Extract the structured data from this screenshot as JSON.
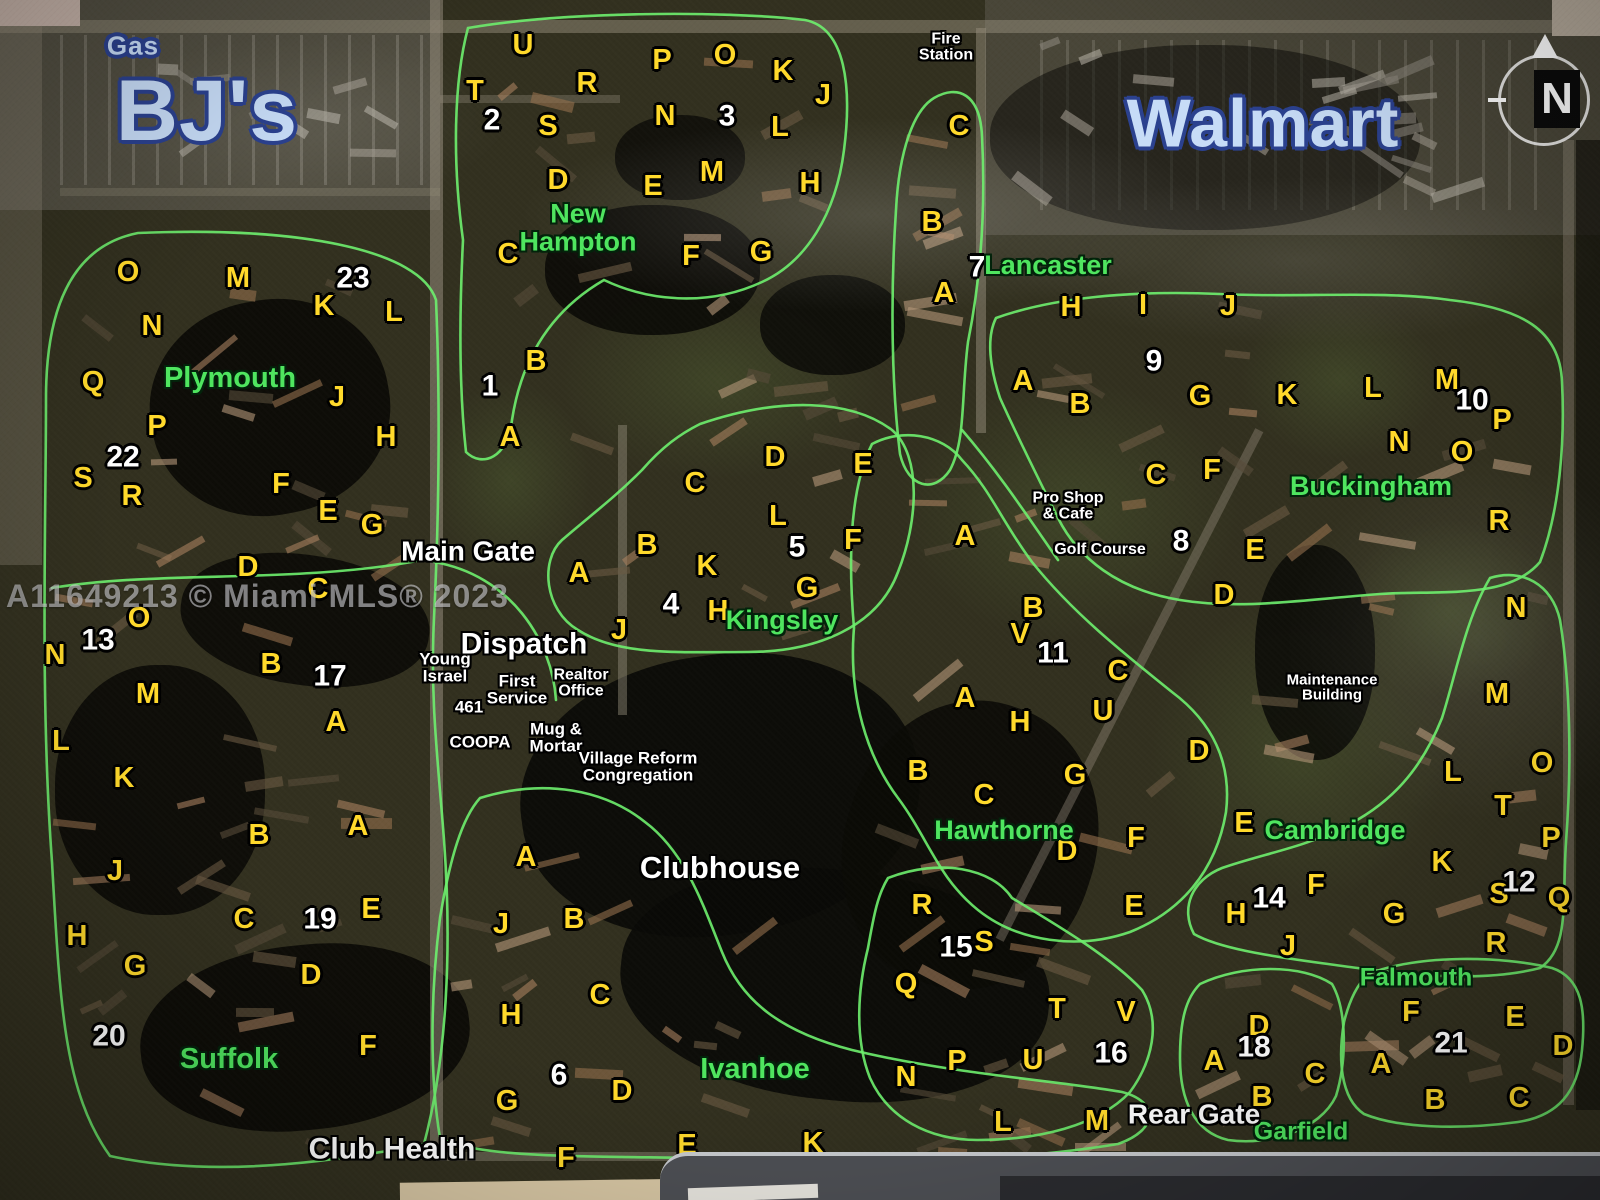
{
  "map": {
    "watermark": {
      "t": "A11649213 © Miami MLS® 2023",
      "x": 168,
      "y": 597
    },
    "compass": {
      "label": "N"
    },
    "colors": {
      "unit_letter": "#ffd92b",
      "block_number": "#ffffff",
      "neighborhood": "#4fe55f",
      "poi": "#ffffff",
      "store_fill": "#c7dcf7",
      "store_outline": "#2b418f",
      "region_outline": "#6ef06e"
    },
    "stores": [
      {
        "t": "Gas",
        "x": 133,
        "y": 46,
        "s": 26
      },
      {
        "t": "BJ's",
        "x": 207,
        "y": 112,
        "s": 86
      },
      {
        "t": "Walmart",
        "x": 1263,
        "y": 124,
        "s": 68
      }
    ],
    "neighborhoods": [
      {
        "t": "New\nHampton",
        "x": 578,
        "y": 228,
        "s": 27
      },
      {
        "t": "Plymouth",
        "x": 230,
        "y": 379,
        "s": 29
      },
      {
        "t": "Lancaster",
        "x": 1048,
        "y": 266,
        "s": 27
      },
      {
        "t": "Buckingham",
        "x": 1371,
        "y": 487,
        "s": 27
      },
      {
        "t": "Kingsley",
        "x": 782,
        "y": 621,
        "s": 27
      },
      {
        "t": "Hawthorne",
        "x": 1004,
        "y": 831,
        "s": 27
      },
      {
        "t": "Cambridge",
        "x": 1335,
        "y": 831,
        "s": 27
      },
      {
        "t": "Suffolk",
        "x": 229,
        "y": 1060,
        "s": 29
      },
      {
        "t": "Ivanhoe",
        "x": 755,
        "y": 1070,
        "s": 29
      },
      {
        "t": "Falmouth",
        "x": 1416,
        "y": 978,
        "s": 25
      },
      {
        "t": "Garfield",
        "x": 1301,
        "y": 1132,
        "s": 25
      }
    ],
    "pois": [
      {
        "t": "Fire\nStation",
        "x": 946,
        "y": 48,
        "s": 16
      },
      {
        "t": "Main Gate",
        "x": 468,
        "y": 552,
        "s": 28
      },
      {
        "t": "Dispatch",
        "x": 524,
        "y": 645,
        "s": 30
      },
      {
        "t": "Young\nIsrael",
        "x": 445,
        "y": 668,
        "s": 17
      },
      {
        "t": "First\nService",
        "x": 517,
        "y": 690,
        "s": 17
      },
      {
        "t": "Realtor\nOffice",
        "x": 581,
        "y": 684,
        "s": 16
      },
      {
        "t": "461",
        "x": 469,
        "y": 707,
        "s": 17
      },
      {
        "t": "COOPA",
        "x": 480,
        "y": 742,
        "s": 17
      },
      {
        "t": "Mug &\nMortar",
        "x": 556,
        "y": 738,
        "s": 17
      },
      {
        "t": "Village Reform\nCongregation",
        "x": 638,
        "y": 767,
        "s": 17
      },
      {
        "t": "Clubhouse",
        "x": 720,
        "y": 868,
        "s": 31
      },
      {
        "t": "Pro Shop\n& Cafe",
        "x": 1068,
        "y": 507,
        "s": 16
      },
      {
        "t": "Golf Course",
        "x": 1100,
        "y": 550,
        "s": 16
      },
      {
        "t": "Maintenance\nBuilding",
        "x": 1332,
        "y": 688,
        "s": 15
      },
      {
        "t": "Club Health",
        "x": 392,
        "y": 1150,
        "s": 30
      },
      {
        "t": "Rear Gate",
        "x": 1194,
        "y": 1115,
        "s": 28
      }
    ],
    "numbers": [
      {
        "t": "1",
        "x": 490,
        "y": 387
      },
      {
        "t": "2",
        "x": 492,
        "y": 121
      },
      {
        "t": "3",
        "x": 727,
        "y": 117
      },
      {
        "t": "4",
        "x": 671,
        "y": 605
      },
      {
        "t": "5",
        "x": 797,
        "y": 548
      },
      {
        "t": "6",
        "x": 559,
        "y": 1076
      },
      {
        "t": "7",
        "x": 977,
        "y": 268
      },
      {
        "t": "8",
        "x": 1181,
        "y": 542
      },
      {
        "t": "9",
        "x": 1154,
        "y": 362
      },
      {
        "t": "10",
        "x": 1472,
        "y": 401
      },
      {
        "t": "11",
        "x": 1053,
        "y": 654
      },
      {
        "t": "12",
        "x": 1519,
        "y": 883
      },
      {
        "t": "13",
        "x": 98,
        "y": 641
      },
      {
        "t": "14",
        "x": 1269,
        "y": 899
      },
      {
        "t": "15",
        "x": 956,
        "y": 948
      },
      {
        "t": "16",
        "x": 1111,
        "y": 1054
      },
      {
        "t": "17",
        "x": 330,
        "y": 677
      },
      {
        "t": "18",
        "x": 1254,
        "y": 1048
      },
      {
        "t": "19",
        "x": 320,
        "y": 920
      },
      {
        "t": "20",
        "x": 109,
        "y": 1037
      },
      {
        "t": "21",
        "x": 1451,
        "y": 1044
      },
      {
        "t": "22",
        "x": 123,
        "y": 458
      },
      {
        "t": "23",
        "x": 353,
        "y": 279
      }
    ],
    "letters": [
      {
        "t": "U",
        "x": 523,
        "y": 46
      },
      {
        "t": "O",
        "x": 725,
        "y": 56
      },
      {
        "t": "P",
        "x": 662,
        "y": 61
      },
      {
        "t": "K",
        "x": 783,
        "y": 72
      },
      {
        "t": "R",
        "x": 587,
        "y": 84
      },
      {
        "t": "T",
        "x": 475,
        "y": 92
      },
      {
        "t": "J",
        "x": 823,
        "y": 96
      },
      {
        "t": "N",
        "x": 665,
        "y": 117
      },
      {
        "t": "S",
        "x": 548,
        "y": 127
      },
      {
        "t": "L",
        "x": 780,
        "y": 128
      },
      {
        "t": "M",
        "x": 712,
        "y": 173
      },
      {
        "t": "D",
        "x": 558,
        "y": 181
      },
      {
        "t": "E",
        "x": 653,
        "y": 187
      },
      {
        "t": "H",
        "x": 810,
        "y": 184
      },
      {
        "t": "C",
        "x": 508,
        "y": 255
      },
      {
        "t": "G",
        "x": 761,
        "y": 253
      },
      {
        "t": "F",
        "x": 691,
        "y": 257
      },
      {
        "t": "B",
        "x": 536,
        "y": 362
      },
      {
        "t": "A",
        "x": 510,
        "y": 438
      },
      {
        "t": "C",
        "x": 959,
        "y": 127
      },
      {
        "t": "B",
        "x": 932,
        "y": 223
      },
      {
        "t": "A",
        "x": 944,
        "y": 294
      },
      {
        "t": "H",
        "x": 1071,
        "y": 308
      },
      {
        "t": "I",
        "x": 1143,
        "y": 306
      },
      {
        "t": "J",
        "x": 1228,
        "y": 307
      },
      {
        "t": "A",
        "x": 1023,
        "y": 382
      },
      {
        "t": "B",
        "x": 1080,
        "y": 405
      },
      {
        "t": "G",
        "x": 1200,
        "y": 397
      },
      {
        "t": "K",
        "x": 1287,
        "y": 396
      },
      {
        "t": "L",
        "x": 1373,
        "y": 389
      },
      {
        "t": "M",
        "x": 1447,
        "y": 381
      },
      {
        "t": "N",
        "x": 1399,
        "y": 443
      },
      {
        "t": "O",
        "x": 1462,
        "y": 453
      },
      {
        "t": "P",
        "x": 1502,
        "y": 421
      },
      {
        "t": "R",
        "x": 1499,
        "y": 522
      },
      {
        "t": "C",
        "x": 1156,
        "y": 476
      },
      {
        "t": "F",
        "x": 1212,
        "y": 471
      },
      {
        "t": "E",
        "x": 1255,
        "y": 551
      },
      {
        "t": "D",
        "x": 1224,
        "y": 596
      },
      {
        "t": "O",
        "x": 128,
        "y": 273
      },
      {
        "t": "M",
        "x": 238,
        "y": 279
      },
      {
        "t": "K",
        "x": 324,
        "y": 307
      },
      {
        "t": "L",
        "x": 394,
        "y": 313
      },
      {
        "t": "N",
        "x": 152,
        "y": 327
      },
      {
        "t": "Q",
        "x": 93,
        "y": 383
      },
      {
        "t": "J",
        "x": 337,
        "y": 398
      },
      {
        "t": "P",
        "x": 157,
        "y": 427
      },
      {
        "t": "H",
        "x": 386,
        "y": 438
      },
      {
        "t": "S",
        "x": 83,
        "y": 479
      },
      {
        "t": "F",
        "x": 281,
        "y": 485
      },
      {
        "t": "R",
        "x": 132,
        "y": 497
      },
      {
        "t": "E",
        "x": 328,
        "y": 512
      },
      {
        "t": "G",
        "x": 372,
        "y": 526
      },
      {
        "t": "D",
        "x": 248,
        "y": 568
      },
      {
        "t": "C",
        "x": 318,
        "y": 590
      },
      {
        "t": "B",
        "x": 271,
        "y": 665
      },
      {
        "t": "A",
        "x": 336,
        "y": 723
      },
      {
        "t": "O",
        "x": 139,
        "y": 619
      },
      {
        "t": "N",
        "x": 55,
        "y": 656
      },
      {
        "t": "M",
        "x": 148,
        "y": 695
      },
      {
        "t": "L",
        "x": 61,
        "y": 742
      },
      {
        "t": "K",
        "x": 124,
        "y": 779
      },
      {
        "t": "J",
        "x": 115,
        "y": 872
      },
      {
        "t": "H",
        "x": 77,
        "y": 937
      },
      {
        "t": "G",
        "x": 135,
        "y": 967
      },
      {
        "t": "D",
        "x": 775,
        "y": 458
      },
      {
        "t": "E",
        "x": 863,
        "y": 465
      },
      {
        "t": "C",
        "x": 695,
        "y": 484
      },
      {
        "t": "L",
        "x": 778,
        "y": 517
      },
      {
        "t": "F",
        "x": 853,
        "y": 541
      },
      {
        "t": "B",
        "x": 647,
        "y": 546
      },
      {
        "t": "K",
        "x": 707,
        "y": 567
      },
      {
        "t": "A",
        "x": 579,
        "y": 574
      },
      {
        "t": "G",
        "x": 807,
        "y": 589
      },
      {
        "t": "H",
        "x": 718,
        "y": 612
      },
      {
        "t": "J",
        "x": 619,
        "y": 631
      },
      {
        "t": "A",
        "x": 965,
        "y": 537
      },
      {
        "t": "B",
        "x": 1033,
        "y": 609
      },
      {
        "t": "V",
        "x": 1020,
        "y": 635
      },
      {
        "t": "C",
        "x": 1118,
        "y": 672
      },
      {
        "t": "A",
        "x": 965,
        "y": 699
      },
      {
        "t": "U",
        "x": 1103,
        "y": 712
      },
      {
        "t": "H",
        "x": 1020,
        "y": 723
      },
      {
        "t": "D",
        "x": 1199,
        "y": 752
      },
      {
        "t": "B",
        "x": 918,
        "y": 772
      },
      {
        "t": "G",
        "x": 1075,
        "y": 776
      },
      {
        "t": "C",
        "x": 984,
        "y": 796
      },
      {
        "t": "F",
        "x": 1136,
        "y": 839
      },
      {
        "t": "D",
        "x": 1067,
        "y": 852
      },
      {
        "t": "E",
        "x": 1134,
        "y": 907
      },
      {
        "t": "R",
        "x": 922,
        "y": 906
      },
      {
        "t": "S",
        "x": 984,
        "y": 943
      },
      {
        "t": "Q",
        "x": 906,
        "y": 985
      },
      {
        "t": "T",
        "x": 1057,
        "y": 1010
      },
      {
        "t": "V",
        "x": 1126,
        "y": 1013
      },
      {
        "t": "U",
        "x": 1033,
        "y": 1061
      },
      {
        "t": "P",
        "x": 957,
        "y": 1062
      },
      {
        "t": "N",
        "x": 906,
        "y": 1078
      },
      {
        "t": "L",
        "x": 1003,
        "y": 1123
      },
      {
        "t": "M",
        "x": 1097,
        "y": 1122
      },
      {
        "t": "A",
        "x": 526,
        "y": 858
      },
      {
        "t": "B",
        "x": 574,
        "y": 920
      },
      {
        "t": "J",
        "x": 501,
        "y": 925
      },
      {
        "t": "C",
        "x": 600,
        "y": 996
      },
      {
        "t": "H",
        "x": 511,
        "y": 1016
      },
      {
        "t": "D",
        "x": 622,
        "y": 1092
      },
      {
        "t": "G",
        "x": 507,
        "y": 1102
      },
      {
        "t": "E",
        "x": 687,
        "y": 1146
      },
      {
        "t": "K",
        "x": 813,
        "y": 1144
      },
      {
        "t": "F",
        "x": 566,
        "y": 1159
      },
      {
        "t": "B",
        "x": 259,
        "y": 836
      },
      {
        "t": "A",
        "x": 358,
        "y": 827
      },
      {
        "t": "C",
        "x": 244,
        "y": 920
      },
      {
        "t": "E",
        "x": 371,
        "y": 910
      },
      {
        "t": "D",
        "x": 311,
        "y": 976
      },
      {
        "t": "F",
        "x": 368,
        "y": 1047
      },
      {
        "t": "N",
        "x": 1516,
        "y": 609
      },
      {
        "t": "M",
        "x": 1497,
        "y": 695
      },
      {
        "t": "L",
        "x": 1453,
        "y": 773
      },
      {
        "t": "O",
        "x": 1542,
        "y": 764
      },
      {
        "t": "T",
        "x": 1503,
        "y": 807
      },
      {
        "t": "E",
        "x": 1244,
        "y": 824
      },
      {
        "t": "P",
        "x": 1551,
        "y": 839
      },
      {
        "t": "K",
        "x": 1442,
        "y": 863
      },
      {
        "t": "F",
        "x": 1316,
        "y": 886
      },
      {
        "t": "S",
        "x": 1499,
        "y": 895
      },
      {
        "t": "Q",
        "x": 1559,
        "y": 899
      },
      {
        "t": "G",
        "x": 1394,
        "y": 915
      },
      {
        "t": "H",
        "x": 1236,
        "y": 915
      },
      {
        "t": "R",
        "x": 1496,
        "y": 944
      },
      {
        "t": "J",
        "x": 1288,
        "y": 947
      },
      {
        "t": "D",
        "x": 1259,
        "y": 1027
      },
      {
        "t": "A",
        "x": 1214,
        "y": 1062
      },
      {
        "t": "C",
        "x": 1315,
        "y": 1075
      },
      {
        "t": "B",
        "x": 1262,
        "y": 1098
      },
      {
        "t": "F",
        "x": 1411,
        "y": 1013
      },
      {
        "t": "E",
        "x": 1515,
        "y": 1018
      },
      {
        "t": "D",
        "x": 1563,
        "y": 1047
      },
      {
        "t": "A",
        "x": 1381,
        "y": 1065
      },
      {
        "t": "B",
        "x": 1435,
        "y": 1101
      },
      {
        "t": "C",
        "x": 1519,
        "y": 1099
      }
    ]
  }
}
